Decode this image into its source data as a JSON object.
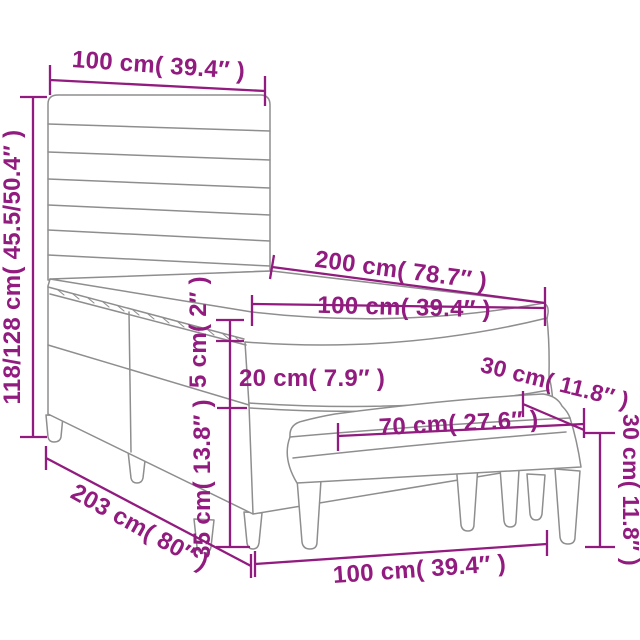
{
  "diagram_type": "furniture-dimension-drawing",
  "subject": "box-spring-bed-with-headboard-and-bench",
  "labels": {
    "headboard_width": "100 cm( 39.4″ )",
    "overall_height": "118/128 cm( 45.5/50.4″ )",
    "bed_length": "200 cm( 78.7″ )",
    "mattress_width": "100 cm( 39.4″ )",
    "topper_thickness": "5 cm( 2″ )",
    "mattress_thickness": "20 cm( 7.9″ )",
    "bench_depth": "30 cm( 11.8″ )",
    "bench_length": "70 cm( 27.6″ )",
    "base_height": "35 cm( 13.8″ )",
    "bench_height": "30 cm( 11.8″ )",
    "overall_length": "203 cm( 80″ )",
    "overall_width": "100 cm( 39.4″ )"
  },
  "colors": {
    "dimension": "#911b7e",
    "outline": "#8e8e8e",
    "background": "#ffffff"
  }
}
